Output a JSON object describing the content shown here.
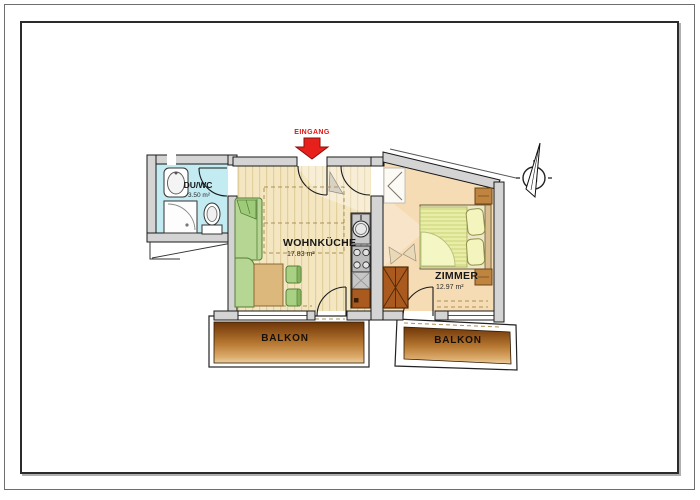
{
  "plan": {
    "entrance_label": "EINGANG",
    "rooms": {
      "duwc": {
        "name": "DU/WC",
        "area": "3.50 m²"
      },
      "wohnkueche": {
        "name": "WOHNKÜCHE",
        "area": "17.83 m²"
      },
      "zimmer": {
        "name": "ZIMMER",
        "area": "12.97 m²"
      },
      "balkon_left": {
        "name": "BALKON"
      },
      "balkon_right": {
        "name": "BALKON"
      }
    },
    "compass": {
      "north_label": "N"
    },
    "colors": {
      "wall": "#d4d4d4",
      "duwc_floor": "#c3ebf2",
      "wohnkueche_floor_base": "#f3e6c1",
      "wohnkueche_floor_stripe": "#e2cf9e",
      "zimmer_floor": "#f6dcb5",
      "balcony_dark": "#6f3608",
      "balcony_mid": "#b4752f",
      "balcony_light": "#e9cfa0",
      "furniture_green": "#b6d694",
      "furniture_green_dark": "#567f38",
      "table_tan": "#ddb87c",
      "wood_brown": "#aa5a1e",
      "bed_blanket": "#e9eda5",
      "pillow": "#f4f4be",
      "nightstand": "#bf8440",
      "entrance_arrow": "#e8201c"
    }
  }
}
